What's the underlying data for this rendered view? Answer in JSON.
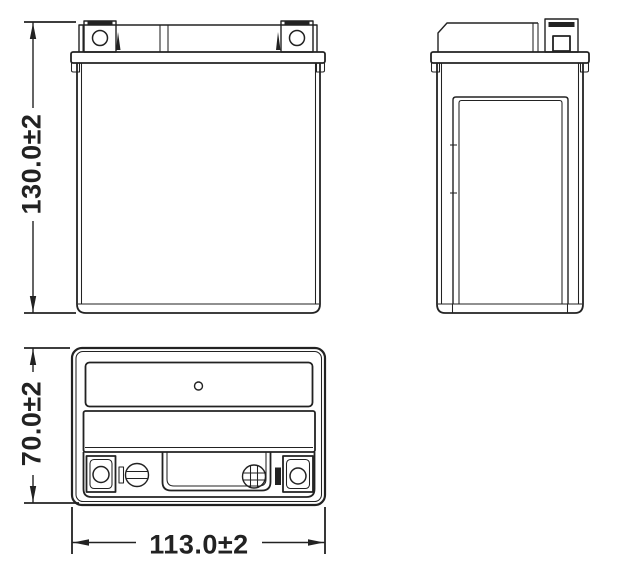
{
  "colors": {
    "background": "#ffffff",
    "line": "#222222"
  },
  "dimensions": {
    "height": {
      "label": "130.0±2"
    },
    "depth": {
      "label": "70.0±2"
    },
    "width": {
      "label": "113.0±2"
    }
  },
  "symbols": {
    "negative_terminal_marker": "minus-screw-icon",
    "positive_terminal_marker": "plus-screw-icon"
  }
}
